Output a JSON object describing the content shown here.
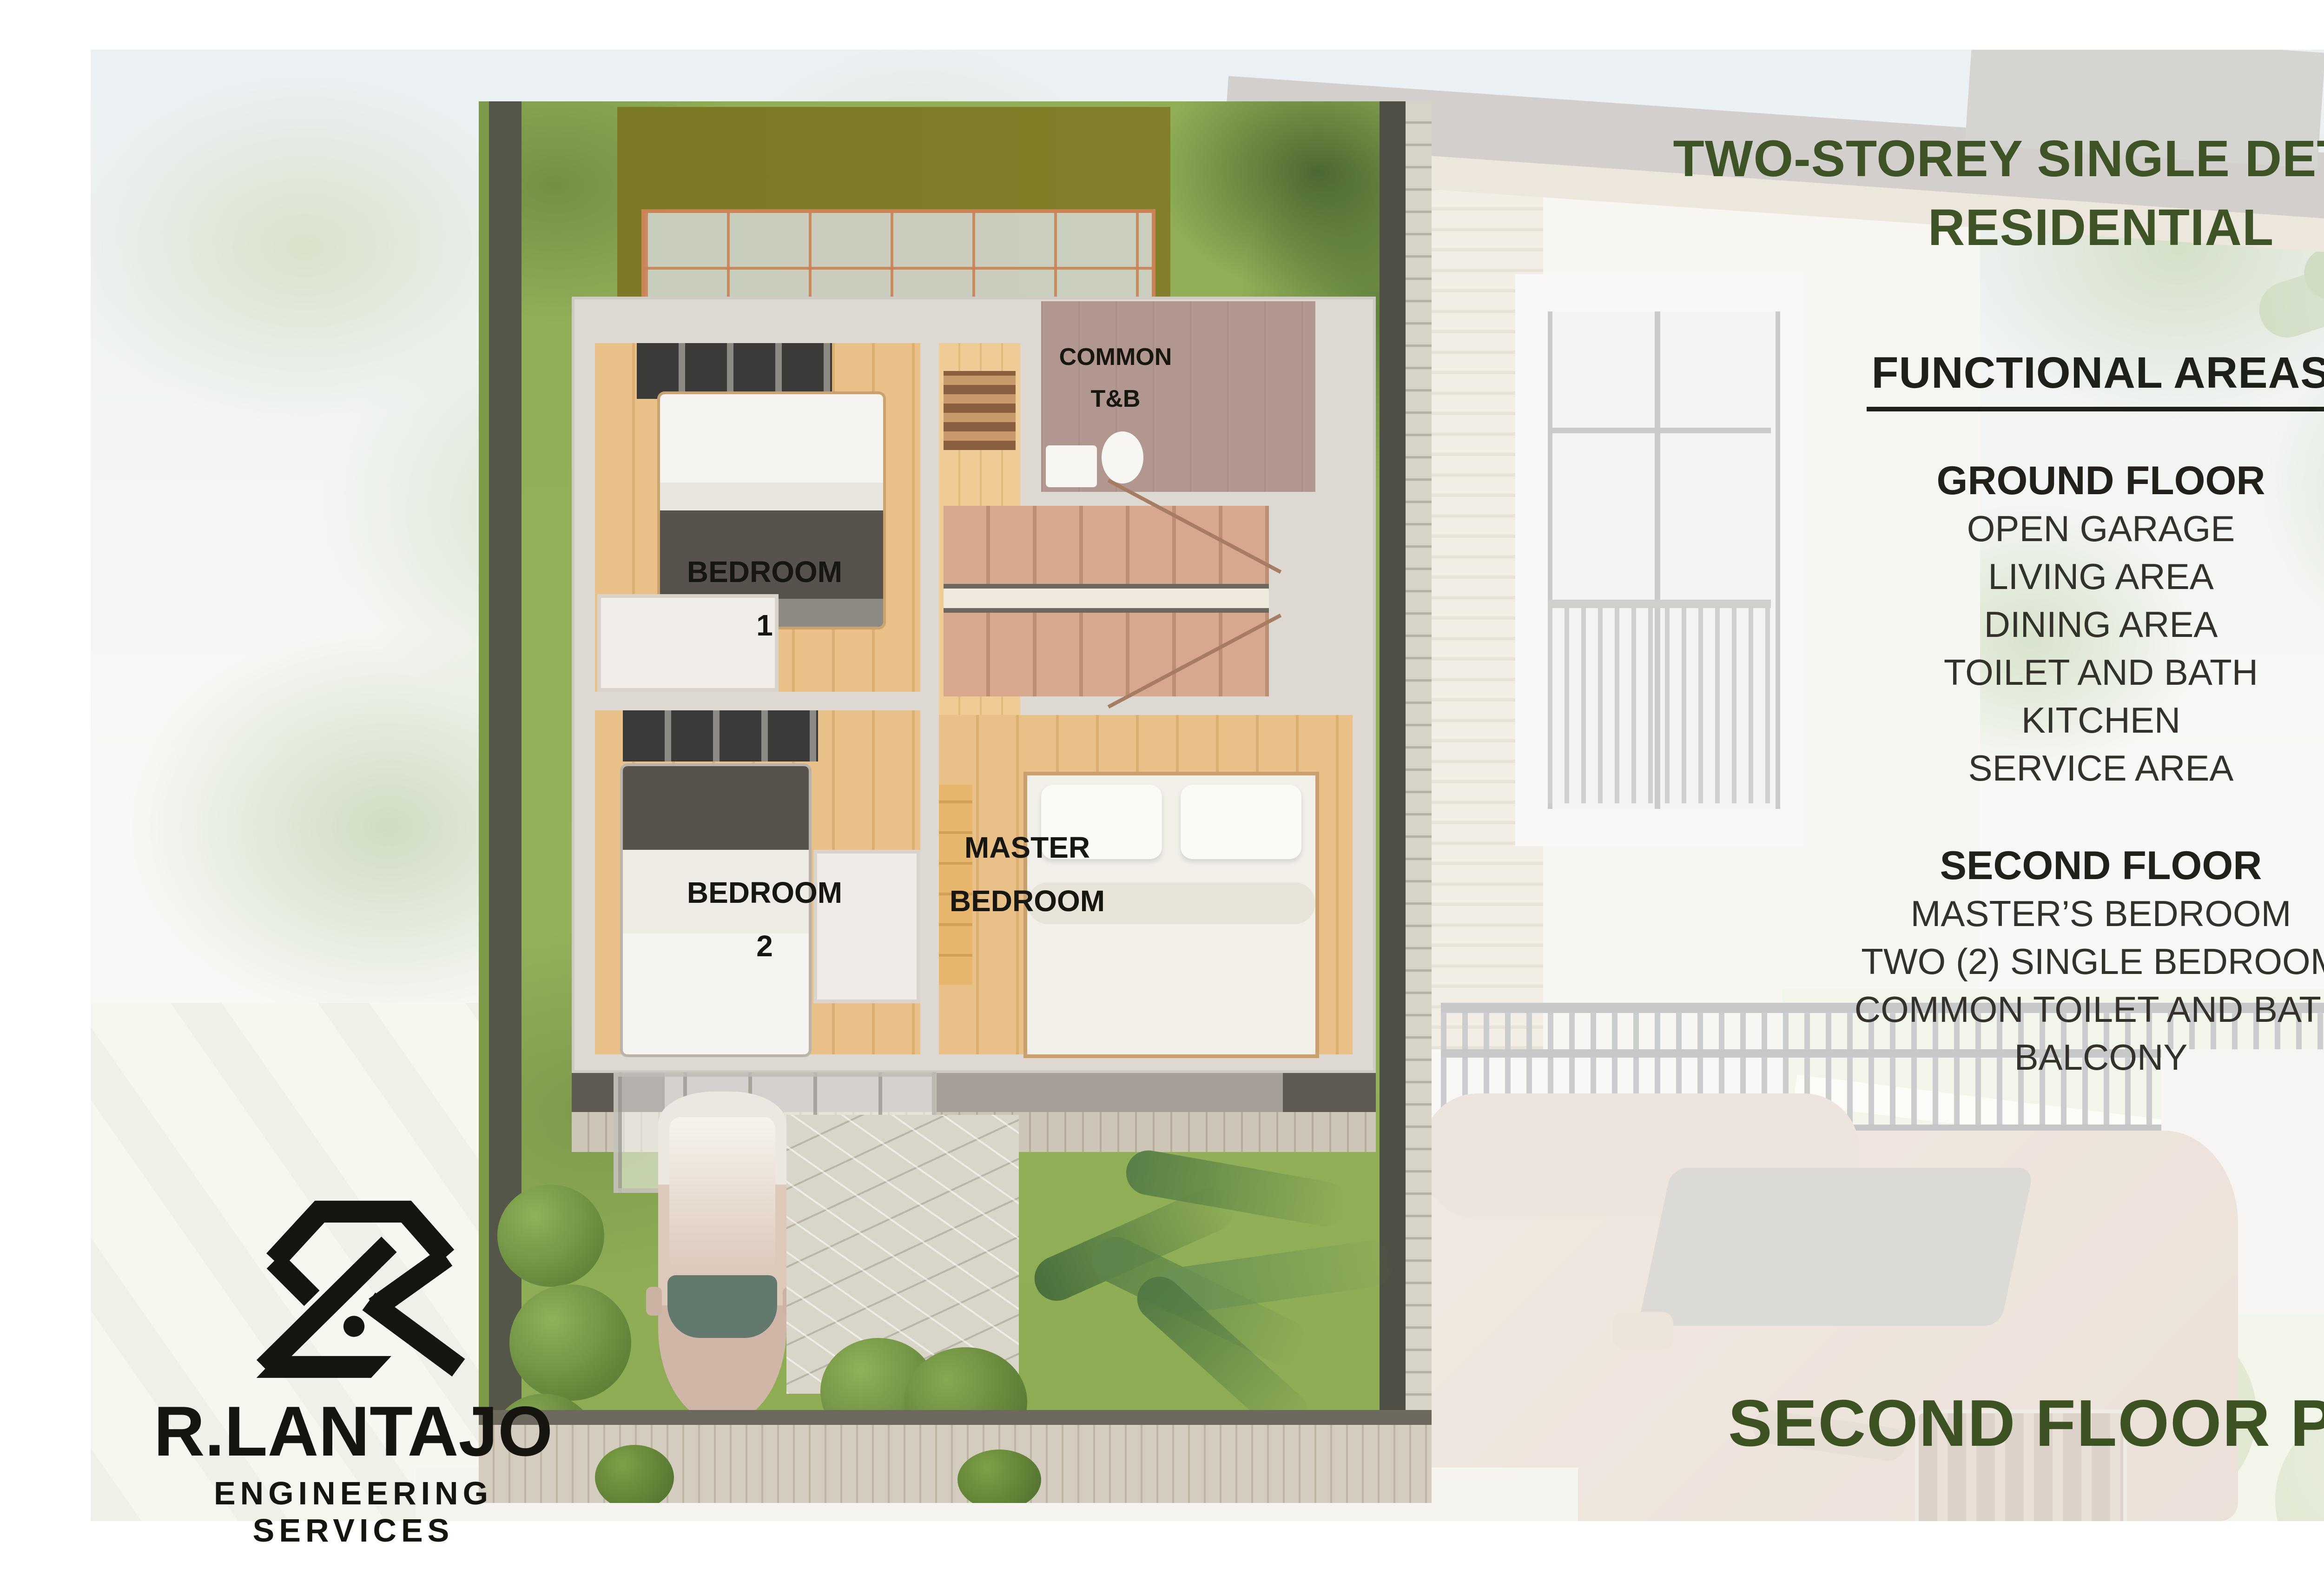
{
  "title": {
    "line1": "TWO-STOREY SINGLE DETACHED",
    "line2": "RESIDENTIAL"
  },
  "functional": {
    "heading": "FUNCTIONAL AREAS",
    "ground": {
      "heading": "GROUND FLOOR",
      "items": [
        "OPEN GARAGE",
        "LIVING AREA",
        "DINING AREA",
        "TOILET AND BATH",
        "KITCHEN",
        "SERVICE AREA"
      ]
    },
    "second": {
      "heading": "SECOND FLOOR",
      "items": [
        "MASTER’S BEDROOM",
        "TWO (2) SINGLE BEDROOM",
        "COMMON TOILET AND BATH",
        "BALCONY"
      ]
    }
  },
  "caption": "SECOND FLOOR PLAN",
  "plan": {
    "bedroom1": {
      "l1": "BEDROOM",
      "l2": "1"
    },
    "bedroom2": {
      "l1": "BEDROOM",
      "l2": "2"
    },
    "master": {
      "l1": "MASTER",
      "l2": "BEDROOM"
    },
    "tnb": {
      "l1": "COMMON",
      "l2": "T&B"
    }
  },
  "logo": {
    "name": "R.LANTAJO",
    "subtitle": "ENGINEERING SERVICES"
  },
  "colors": {
    "accent_green": "#3f5426",
    "text_dark": "#20201a",
    "grass_green": "#93b159",
    "roof_olive": "#7e7c26"
  }
}
